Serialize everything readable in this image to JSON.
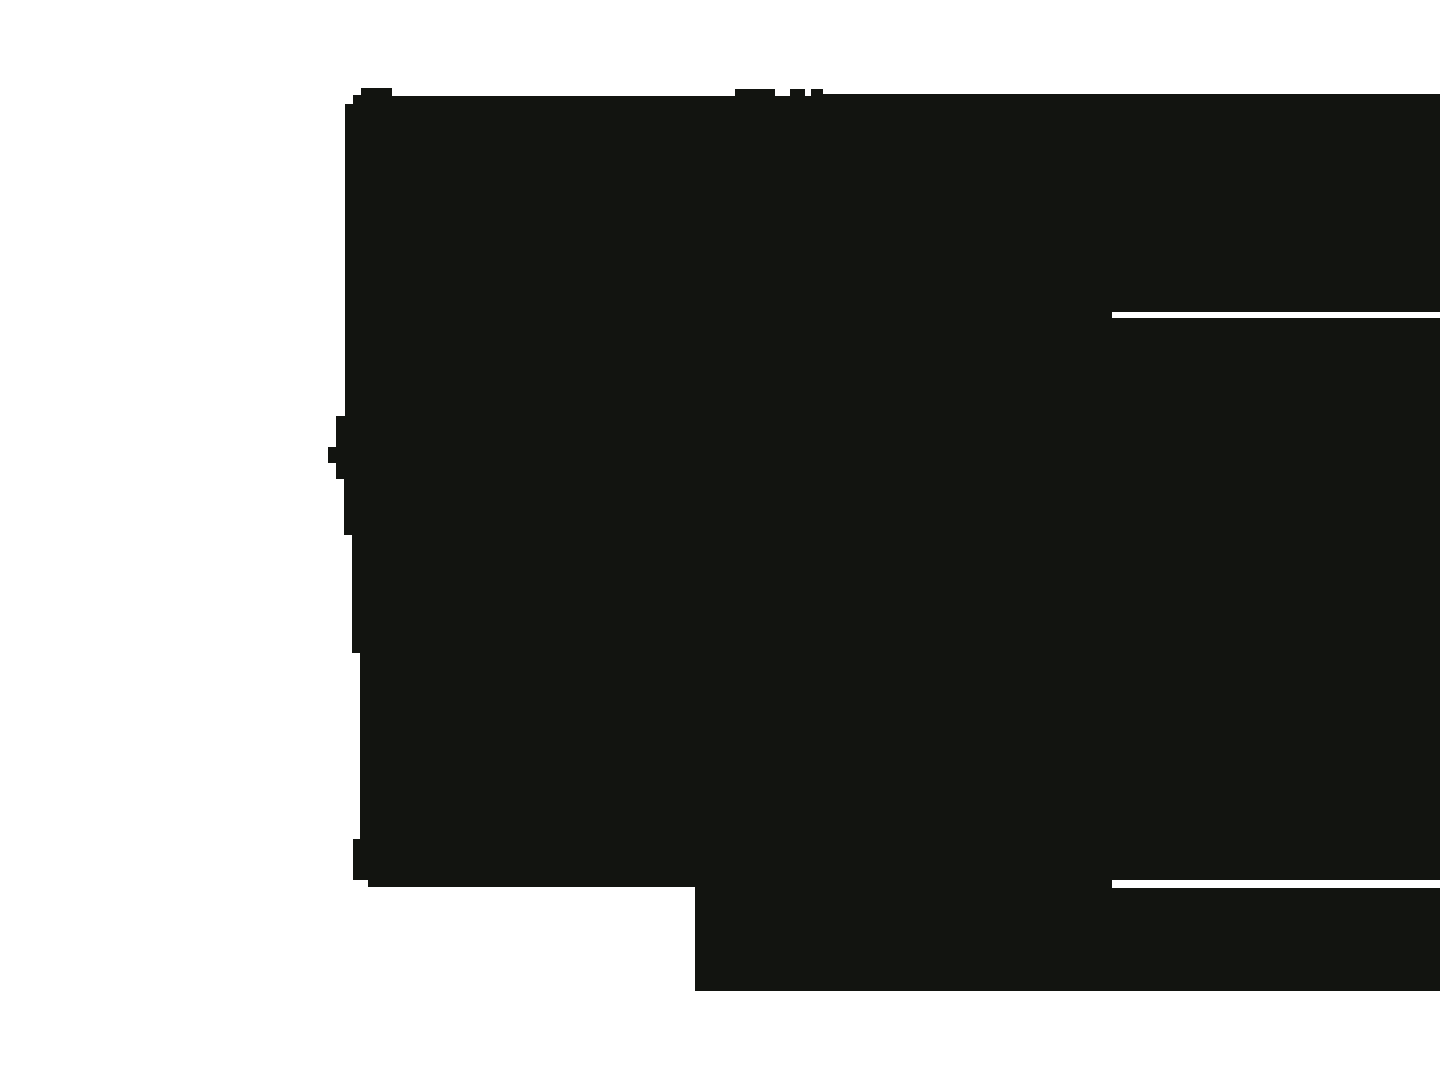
{
  "canvas": {
    "width": 1440,
    "height": 1080
  },
  "colors": {
    "background": "#ffffff",
    "silhouette": "#121410"
  },
  "silhouette": {
    "description": "Single large solid near-black irregular blob covering roughly x=328-1440, y=88-991 on a white field. Flat top edge (~y=94-96) with three small raised bumps (~y=88-89) near x=353-392, x=735-775, x=790-805, x=811-823. Stepped left edge with two small nubs protruding left (x=328 at y=447-463 and x=353 at y=839-880). Two thin white horizontal slits cut in from the right image edge starting at x=1112 (y=312-318 and y=880-888). Lower-left bottom edge at y=887 ends at x=695 where a full-width tongue continues down to y=991, flush with the right image edge.",
    "points": "345,104 353,104 353,95 361,95 361,88 392,88 392,96 735,96 735,89 775,89 775,96 790,96 790,89 805,89 805,96 811,96 811,89 823,89 823,94 1440,94 1440,312 1112,312 1112,318 1440,318 1440,880 1112,880 1112,888 1440,888 1440,991 695,991 695,887 368,887 368,880 353,880 353,839 360,839 360,653 352,653 352,535 344,535 344,479 336,479 336,463 328,463 328,447 336,447 336,416 345,416",
    "white_slits": [
      {
        "x_start": 1112,
        "x_end": 1440,
        "y_top": 312,
        "y_bottom": 318
      },
      {
        "x_start": 1112,
        "x_end": 1440,
        "y_top": 880,
        "y_bottom": 888
      }
    ],
    "bottom_tongue": {
      "x_start": 695,
      "x_end": 1440,
      "y_top": 887,
      "y_bottom": 991
    }
  }
}
